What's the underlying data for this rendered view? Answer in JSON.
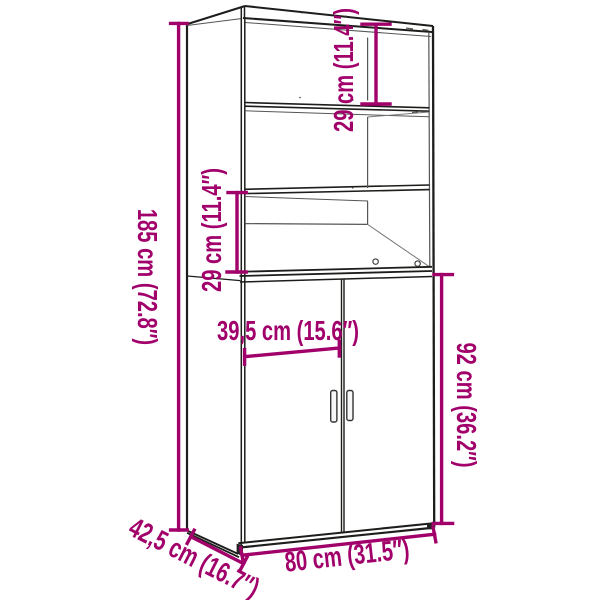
{
  "diagram": {
    "type": "furniture-dimension-diagram",
    "product": "highboard-cabinet-with-shelves-and-doors",
    "background_color": "#FFFFFF",
    "line_color": "#1D1D1B",
    "accent_color": "#A1006B",
    "dimensions": {
      "total_height": {
        "label": "185 cm (72.8″)",
        "cm": 185,
        "inches": 72.8
      },
      "top_compartment_height": {
        "label": "29 cm (11.4″)",
        "cm": 29,
        "inches": 11.4
      },
      "lower_compartment_height": {
        "label": "29 cm (11.4″)",
        "cm": 29,
        "inches": 11.4
      },
      "door_width": {
        "label": "39,5 cm (15.6″)",
        "cm": 39.5,
        "inches": 15.6
      },
      "door_height": {
        "label": "92 cm (36.2″)",
        "cm": 92,
        "inches": 36.2
      },
      "total_width": {
        "label": "80 cm (31.5″)",
        "cm": 80,
        "inches": 31.5
      },
      "depth": {
        "label": "42,5 cm (16.7″)",
        "cm": 42.5,
        "inches": 16.7
      }
    }
  }
}
